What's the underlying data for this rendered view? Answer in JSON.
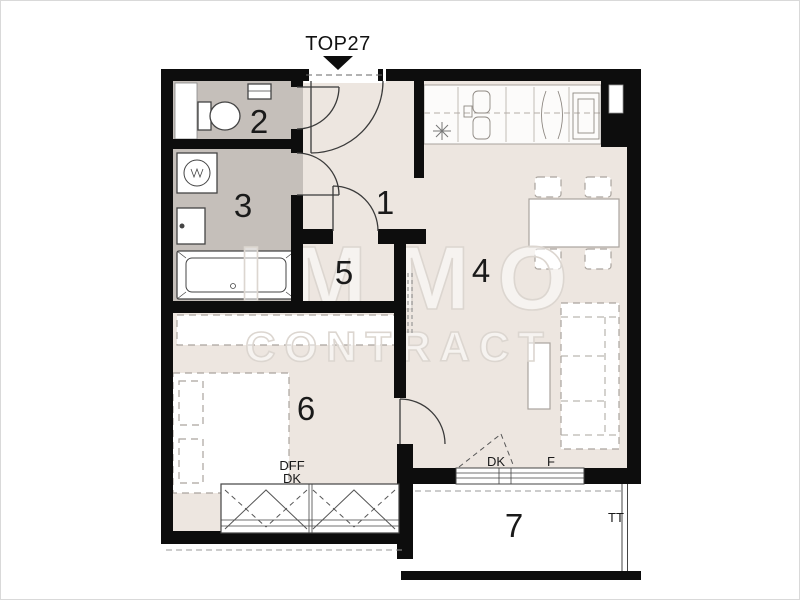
{
  "plan": {
    "unit_label": "TOP27",
    "watermark": {
      "line1": "IMMO",
      "line2": "CONTRACT"
    },
    "rooms": [
      {
        "number": "1"
      },
      {
        "number": "2"
      },
      {
        "number": "3"
      },
      {
        "number": "4"
      },
      {
        "number": "5"
      },
      {
        "number": "6"
      },
      {
        "number": "7"
      }
    ],
    "labels": {
      "living_door": "DK",
      "living_window": "F",
      "bedroom_line1": "DFF",
      "bedroom_line2": "DK",
      "terrace": "TT"
    },
    "colors": {
      "wall": "#0d0d0d",
      "room_light": "#ede6e0",
      "room_wet": "#c5bfba",
      "balcony": "#ffffff",
      "watermark": "#dcd6d0"
    }
  }
}
